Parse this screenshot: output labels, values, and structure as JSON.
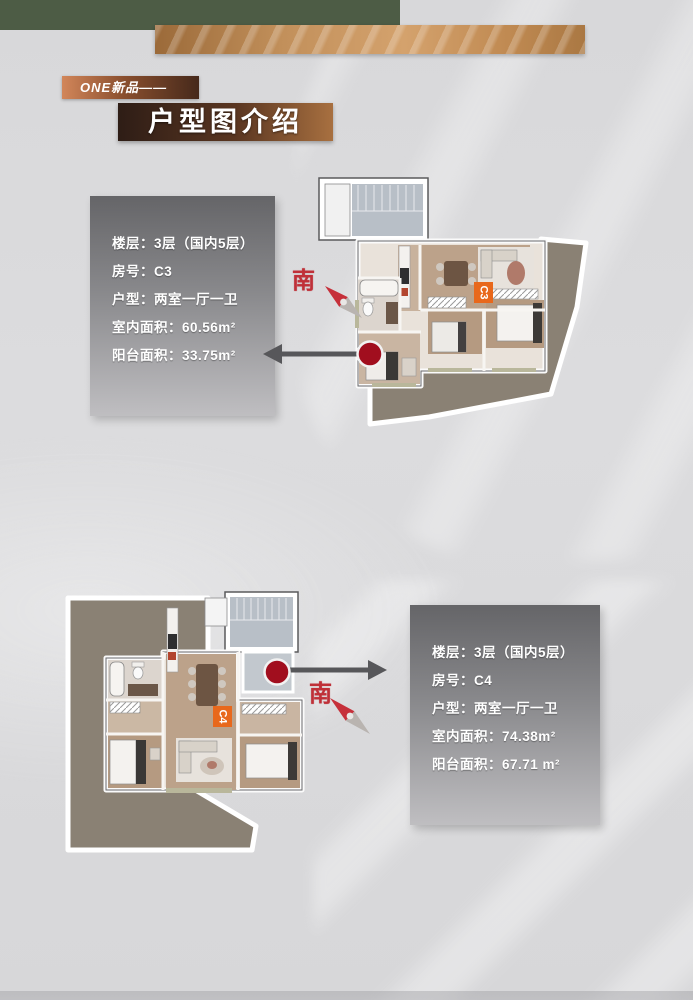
{
  "canvas": {
    "width": 693,
    "height": 1000,
    "background": "#dadadc"
  },
  "decor": {
    "green_bar_color": "#4d5c45",
    "copper_bar_colors": [
      "#9b6a39",
      "#d4a26d",
      "#aa7843"
    ],
    "bottom_strip_color": "#c8c8ca"
  },
  "header": {
    "eyebrow": "ONE新品——",
    "title": "户型图介绍"
  },
  "units": [
    {
      "badge": "C3",
      "compass_stamp": "南",
      "info_rows": [
        "楼层：3层（国内5层）",
        "房号：C3",
        "户型：两室一厅一卫",
        "室内面积：60.56m²",
        "阳台面积：33.75m²"
      ]
    },
    {
      "badge": "C4",
      "compass_stamp": "南",
      "info_rows": [
        "楼层：3层（国内5层）",
        "房号：C4",
        "户型：两室一厅一卫",
        "室内面积：74.38m²",
        "阳台面积：67.71 m²"
      ]
    }
  ],
  "colors": {
    "terrace": "#8a8174",
    "wood_floor": "#bca28a",
    "stair_floor": "#b8bfc7",
    "bath_floor": "#dcd5ce",
    "badge_orange": "#e8681c",
    "arrow_gray": "#57575a",
    "marker_red": "#a10e1e",
    "compass_red": "#c03038",
    "info_card_top": "#656568",
    "info_card_bottom": "#bfbec1"
  }
}
